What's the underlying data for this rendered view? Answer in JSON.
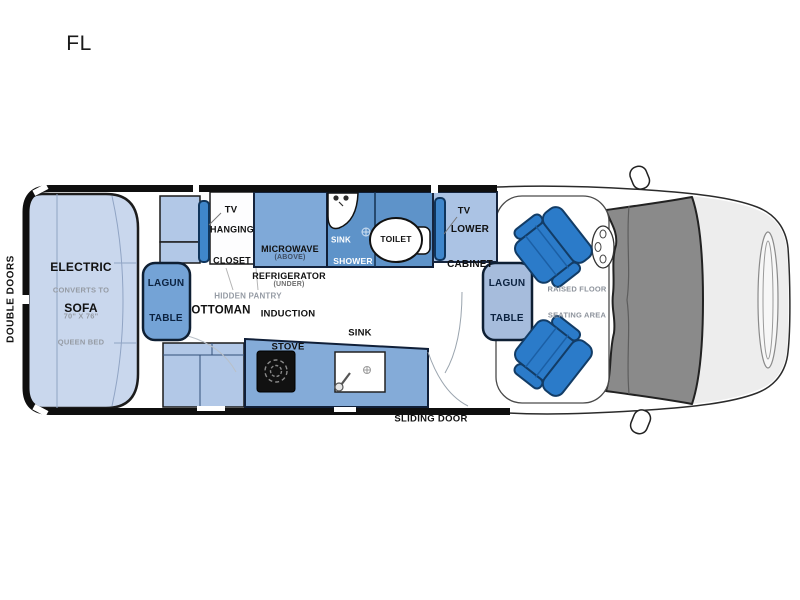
{
  "floorplan": {
    "code": "FL",
    "exterior": {
      "rear_doors": "DOUBLE DOORS",
      "side_door": "SLIDING DOOR"
    },
    "living": {
      "sofa": {
        "line1": "ELECTRIC",
        "line2": "SOFA",
        "note1": "CONVERTS TO",
        "note2": "70\" X 76\"",
        "note3": "QUEEN BED"
      },
      "lagun_rear": {
        "line1": "LAGUN",
        "line2": "TABLE"
      },
      "ottoman": "OTTOMAN",
      "hidden_pantry": "HIDDEN PANTRY"
    },
    "galley_wall": {
      "tv_rear": "TV",
      "closet_line1": "HANGING",
      "closet_line2": "CLOSET",
      "microwave": "MICROWAVE",
      "microwave_sub": "(ABOVE)",
      "refrigerator": "REFRIGERATOR",
      "refrigerator_sub": "(UNDER)"
    },
    "bath": {
      "sink": "SINK",
      "shower": "SHOWER",
      "toilet": "TOILET"
    },
    "front_cabinet": {
      "tv_front": "TV",
      "line1": "LOWER",
      "line2": "CABINET"
    },
    "kitchen": {
      "stove_line1": "INDUCTION",
      "stove_line2": "STOVE",
      "sink": "SINK"
    },
    "cab": {
      "lagun_front": {
        "line1": "LAGUN",
        "line2": "TABLE"
      },
      "raised_line1": "RAISED FLOOR",
      "raised_line2": "SEATING AREA"
    },
    "palette": {
      "wall_black": "#0f0f0f",
      "sofa_fill": "#c9d7ed",
      "cabinet_light": "#b2c8e7",
      "galley_medium": "#7fa9d8",
      "bath_blue": "#5e93c9",
      "counter_blue": "#84abd8",
      "chair_blue": "#2b7bc9",
      "tv_bar_blue": "#3f86cb",
      "lagun_rear_fill": "#74a3d6",
      "lagun_front_fill": "#a6bcdc",
      "glass_gray": "#8a8a8a",
      "hood_gray": "#ededed",
      "note_gray": "#959ba4"
    }
  }
}
